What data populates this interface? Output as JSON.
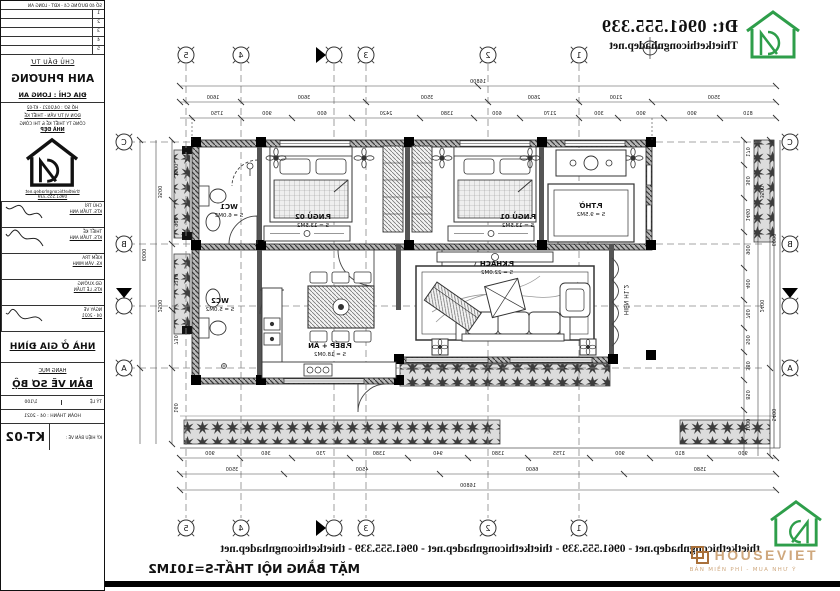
{
  "header": {
    "phone": "Đt: 0961.555.339",
    "website": "Thietkethicongnhadep.net"
  },
  "footer": {
    "marquee": "thietkethicongnhadep.net - 0961.555.339 - thietkethicongnhadep.net - 0961.555.339 - thietkethicongnhadep.net",
    "drawing_title": "MẶT BẰNG NỘI THẤT-S=101M2"
  },
  "watermark": {
    "brand": "HOUSEVIET",
    "tagline": "BẢN MIỀN PHÍ - MUA NHƯ Ý"
  },
  "colors": {
    "brand_green": "#2e9e4a",
    "watermark_tan": "#cfa87e",
    "watermark_brown": "#a9703a",
    "line": "#1c1c1c"
  },
  "title_block": {
    "address_line": "SỐ 40 ĐƯỜNG C4 - KĐT - LONG AN",
    "revision_rows": [
      "1",
      "2",
      "3",
      "4",
      "5"
    ],
    "client_label": "CHỦ ĐẦU TƯ",
    "client_name": "ANH PHƯƠNG",
    "client_address": "ĐỊA CHỈ : LONG AN",
    "record_line": "HỒ SƠ : 04/2021 - KT-02",
    "firm_label": "ĐƠN VỊ TƯ VẤN - THIẾT KẾ",
    "firm_name": "CÔNG TY THIẾT KẾ & THI CÔNG",
    "firm_brand": "NHÀ ĐẸP",
    "firm_site": "thietkethicongnhadep.net",
    "firm_phone": "0961.555.339",
    "sign_rows": [
      {
        "label": "CHỦ TRÌ",
        "value": "KTS. TUẤN ANH"
      },
      {
        "label": "THIẾT KẾ",
        "value": "KTS. TUẤN ANH"
      },
      {
        "label": "KIỂM TRA",
        "value": "KS. VĂN MINH"
      },
      {
        "label": "GĐ.XƯỞNG",
        "value": "KTS. LÊ TUẤN"
      },
      {
        "label": "NGÀY VẼ",
        "value": "04 - 2021"
      }
    ],
    "project_type": "NHÀ Ở GIA ĐÌNH",
    "category_label": "HẠNG MỤC",
    "drawing_stage": "BẢN VẼ SƠ BỘ",
    "scale_label": "TỶ LỆ",
    "scale_value": "1/100",
    "date_line": "HOÀN THÀNH : 04 - 2021",
    "sheet_label": "KÝ HIỆU BẢN VẼ :",
    "sheet_code": "KT-02"
  },
  "plan": {
    "grid_cols": [
      "1",
      "2",
      "3",
      "4",
      "5"
    ],
    "grid_rows": [
      "A",
      "B",
      "C"
    ],
    "rooms": [
      {
        "name": "P.THỜ",
        "area": "S = 9.5M2"
      },
      {
        "name": "P.NGỦ 01",
        "area": "S = 13.5M2"
      },
      {
        "name": "P.NGỦ 02",
        "area": "S = 13.5M2"
      },
      {
        "name": "WC1",
        "area": "S = 6.0M2"
      },
      {
        "name": "P.KHÁCH",
        "area": "S = 22.0M2"
      },
      {
        "name": "P.BẾP + ĂN",
        "area": "S = 18.0M2"
      },
      {
        "name": "WC2",
        "area": "S = 5.0M2"
      }
    ],
    "porch_label": "HIÊN H1.2",
    "dims": {
      "top_total": "16800",
      "top_mid": [
        "3500",
        "2100",
        "2600",
        "3500",
        "3600",
        "1600"
      ],
      "top_small": [
        "810",
        "900",
        "900",
        "300",
        "2170",
        "600",
        "1380",
        "2420",
        "600",
        "900",
        "1750"
      ],
      "bottom_small": [
        "900",
        "810",
        "900",
        "1755",
        "1380",
        "940",
        "1380",
        "730",
        "360",
        "900"
      ],
      "bottom_mid": [
        "1580",
        "6600",
        "4500",
        "3500"
      ],
      "bottom_total": "16800",
      "side_a_small": [
        "1500",
        "900",
        "3110",
        "730",
        "160"
      ],
      "side_a_mid": [
        "3500",
        "2500"
      ],
      "side_a_total": "6000",
      "side_b_small": [
        "170",
        "360",
        "1460",
        "900",
        "400",
        "760",
        "500",
        "380",
        "850",
        "1000"
      ],
      "side_b_mid": [
        "3500",
        "2400"
      ],
      "side_b_total": "6000",
      "side_b_inner": "5400"
    }
  }
}
